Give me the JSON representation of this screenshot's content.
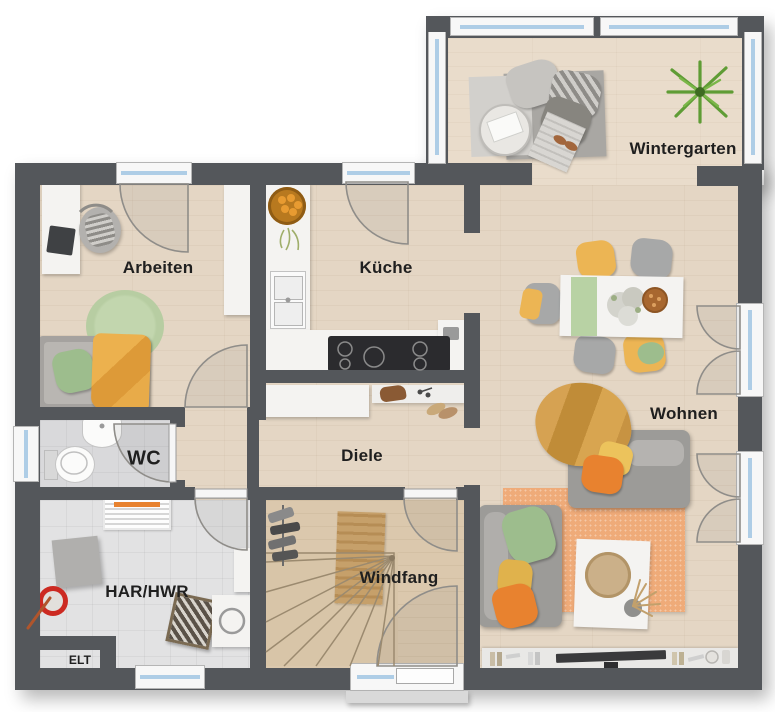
{
  "rooms": {
    "arbeiten": {
      "label": "Arbeiten"
    },
    "kueche": {
      "label": "Küche"
    },
    "wintergarten": {
      "label": "Wintergarten"
    },
    "wohnen": {
      "label": "Wohnen"
    },
    "wc": {
      "label": "WC"
    },
    "diele": {
      "label": "Diele"
    },
    "har_hwr": {
      "label": "HAR/HWR"
    },
    "windfang": {
      "label": "Windfang"
    },
    "elt": {
      "label": "ELT"
    }
  },
  "colors": {
    "wall": "#54575b",
    "floor_wood": "#e4d6c4",
    "floor_wood_light": "#e9dccb",
    "floor_wood_entry": "#dbc8ad",
    "floor_tile": "#e2e2e3",
    "window_glass": "#aecde6",
    "accent_orange": "#e8822f",
    "accent_yellow": "#ecb554",
    "accent_green": "#9dbd8d",
    "accent_mustard": "#d09a44",
    "rug_orange": "#efab79",
    "rug_green": "#b7cda2"
  }
}
